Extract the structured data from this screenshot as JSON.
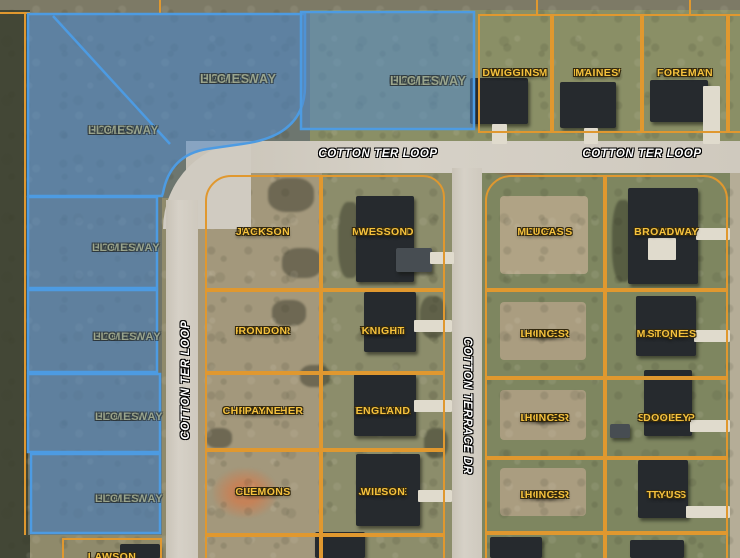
{
  "colors": {
    "parcel_line": "#e0982f",
    "owner_text": "#f6c23d",
    "owner_outline": "#33290f",
    "highlight_fill": "rgba(82,139,203,0.55)",
    "highlight_border": "#4d9be2",
    "highlight_text": "#9fa88d",
    "street_text": "#ffffff"
  },
  "streets": [
    {
      "name": "COTTON TER LOOP",
      "x": 378,
      "y": 154,
      "rotation": 0
    },
    {
      "name": "COTTON TER LOOP",
      "x": 642,
      "y": 154,
      "rotation": 0
    },
    {
      "name": "COTTON TER LOOP",
      "x": 186,
      "y": 380,
      "rotation": -90
    },
    {
      "name": "COTTON TERRACE DR",
      "x": 467,
      "y": 406,
      "rotation": 90
    }
  ],
  "highlighted_owner": "CALLOWAY HOMES LLC",
  "highlight_labels": [
    {
      "lines": [
        "CALLOWAY",
        "HOMES",
        "LLC"
      ],
      "x": 200,
      "y": 72,
      "size": 12.5
    },
    {
      "lines": [
        "CALLOWAY",
        "HOMES",
        "LLC"
      ],
      "x": 88,
      "y": 124,
      "size": 11.5
    },
    {
      "lines": [
        "CALLOWAY",
        "HOMES",
        "LLC"
      ],
      "x": 390,
      "y": 74,
      "size": 12.5
    },
    {
      "lines": [
        "CALLOWAY",
        "HOMES",
        "LLC"
      ],
      "x": 92,
      "y": 241,
      "size": 11
    },
    {
      "lines": [
        "CALLOWAY",
        "HOMES",
        "LLC"
      ],
      "x": 93,
      "y": 330,
      "size": 11
    },
    {
      "lines": [
        "CALLOWAY",
        "HOMES",
        "LLC"
      ],
      "x": 95,
      "y": 410,
      "size": 11
    },
    {
      "lines": [
        "CALLOWAY",
        "HOMES",
        "LLC"
      ],
      "x": 95,
      "y": 492,
      "size": 11
    }
  ],
  "parcels": [
    {
      "id": "wiggins",
      "lines": [
        "DARNELL M",
        "WIGGINS"
      ],
      "x": 478,
      "y": 14,
      "w": 74,
      "h": 119,
      "radius": "0"
    },
    {
      "id": "maines",
      "lines": [
        "DAVID W",
        "MAINES"
      ],
      "x": 552,
      "y": 14,
      "w": 90,
      "h": 119,
      "radius": "0"
    },
    {
      "id": "foreman",
      "lines": [
        "JOHN R",
        "FOREMAN"
      ],
      "x": 642,
      "y": 14,
      "w": 86,
      "h": 119,
      "radius": "0"
    },
    {
      "id": "sliver-ne",
      "lines": [],
      "x": 728,
      "y": 14,
      "w": 14,
      "h": 119,
      "radius": "0"
    },
    {
      "id": "jackson",
      "lines": [
        "PORTIA L",
        "JACKSON"
      ],
      "x": 205,
      "y": 175,
      "w": 116,
      "h": 115,
      "radius": "26px 0 0 0"
    },
    {
      "id": "wesson",
      "lines": [
        "MICHAEL D",
        "WESSON"
      ],
      "x": 321,
      "y": 175,
      "w": 124,
      "h": 115,
      "radius": "0 22px 0 0"
    },
    {
      "id": "rondon",
      "lines": [
        "RAFAEL R",
        "RONDON"
      ],
      "x": 205,
      "y": 290,
      "w": 116,
      "h": 83,
      "radius": "0"
    },
    {
      "id": "knight",
      "lines": [
        "MARK",
        "WILSON",
        "KNIGHT"
      ],
      "x": 321,
      "y": 290,
      "w": 124,
      "h": 83,
      "radius": "0"
    },
    {
      "id": "payne",
      "lines": [
        "CHRISTOPHER",
        "DANIEL",
        "PAYNE"
      ],
      "x": 205,
      "y": 373,
      "w": 116,
      "h": 77,
      "radius": "0"
    },
    {
      "id": "england",
      "lines": [
        "TRACEY A",
        "ENGLAND"
      ],
      "x": 321,
      "y": 373,
      "w": 124,
      "h": 77,
      "radius": "0"
    },
    {
      "id": "clemons",
      "lines": [
        "ELZIE",
        "CLEMONS"
      ],
      "x": 205,
      "y": 450,
      "w": 116,
      "h": 85,
      "radius": "0"
    },
    {
      "id": "wilson",
      "lines": [
        "JAMES E",
        "WILSON"
      ],
      "x": 321,
      "y": 450,
      "w": 124,
      "h": 85,
      "radius": "0"
    },
    {
      "id": "c-part-1",
      "lines": [],
      "x": 205,
      "y": 535,
      "w": 116,
      "h": 30,
      "radius": "0"
    },
    {
      "id": "c-part-2",
      "lines": [],
      "x": 321,
      "y": 535,
      "w": 124,
      "h": 30,
      "radius": "0"
    },
    {
      "id": "lucas",
      "lines": [
        "MONICA S",
        "LUCAS"
      ],
      "x": 485,
      "y": 175,
      "w": 120,
      "h": 115,
      "radius": "26px 0 0 0"
    },
    {
      "id": "broadway",
      "lines": [
        "SHAYLA M",
        "BROADWAY"
      ],
      "x": 605,
      "y": 175,
      "w": 123,
      "h": 115,
      "radius": "0 24px 0 0"
    },
    {
      "id": "lowder-1",
      "lines": [
        "LOWDER",
        "NEW",
        "HOMES",
        "INC"
      ],
      "x": 485,
      "y": 290,
      "w": 120,
      "h": 88,
      "radius": "0"
    },
    {
      "id": "stone",
      "lines": [
        "MARIQUES",
        "STONE"
      ],
      "x": 605,
      "y": 290,
      "w": 123,
      "h": 88,
      "radius": "0"
    },
    {
      "id": "lowder-2",
      "lines": [
        "LOWDER",
        "NEW",
        "HOMES",
        "INC"
      ],
      "x": 485,
      "y": 378,
      "w": 120,
      "h": 80,
      "radius": "0"
    },
    {
      "id": "dooley",
      "lines": [
        "SAMUEL P",
        "DOOLEY"
      ],
      "x": 605,
      "y": 378,
      "w": 123,
      "h": 80,
      "radius": "0"
    },
    {
      "id": "lowder-3",
      "lines": [
        "LOWDER",
        "NEW",
        "HOMES",
        "INC"
      ],
      "x": 485,
      "y": 458,
      "w": 120,
      "h": 75,
      "radius": "0"
    },
    {
      "id": "tyus",
      "lines": [
        "TRAVIS",
        "TYUS"
      ],
      "x": 605,
      "y": 458,
      "w": 123,
      "h": 75,
      "radius": "0"
    },
    {
      "id": "r-part-1",
      "lines": [],
      "x": 485,
      "y": 533,
      "w": 120,
      "h": 30,
      "radius": "0"
    },
    {
      "id": "r-part-2",
      "lines": [],
      "x": 605,
      "y": 533,
      "w": 123,
      "h": 30,
      "radius": "0"
    },
    {
      "id": "lawson",
      "lines": [
        "LAWSON"
      ],
      "x": 62,
      "y": 538,
      "w": 100,
      "h": 38,
      "radius": "0"
    }
  ]
}
